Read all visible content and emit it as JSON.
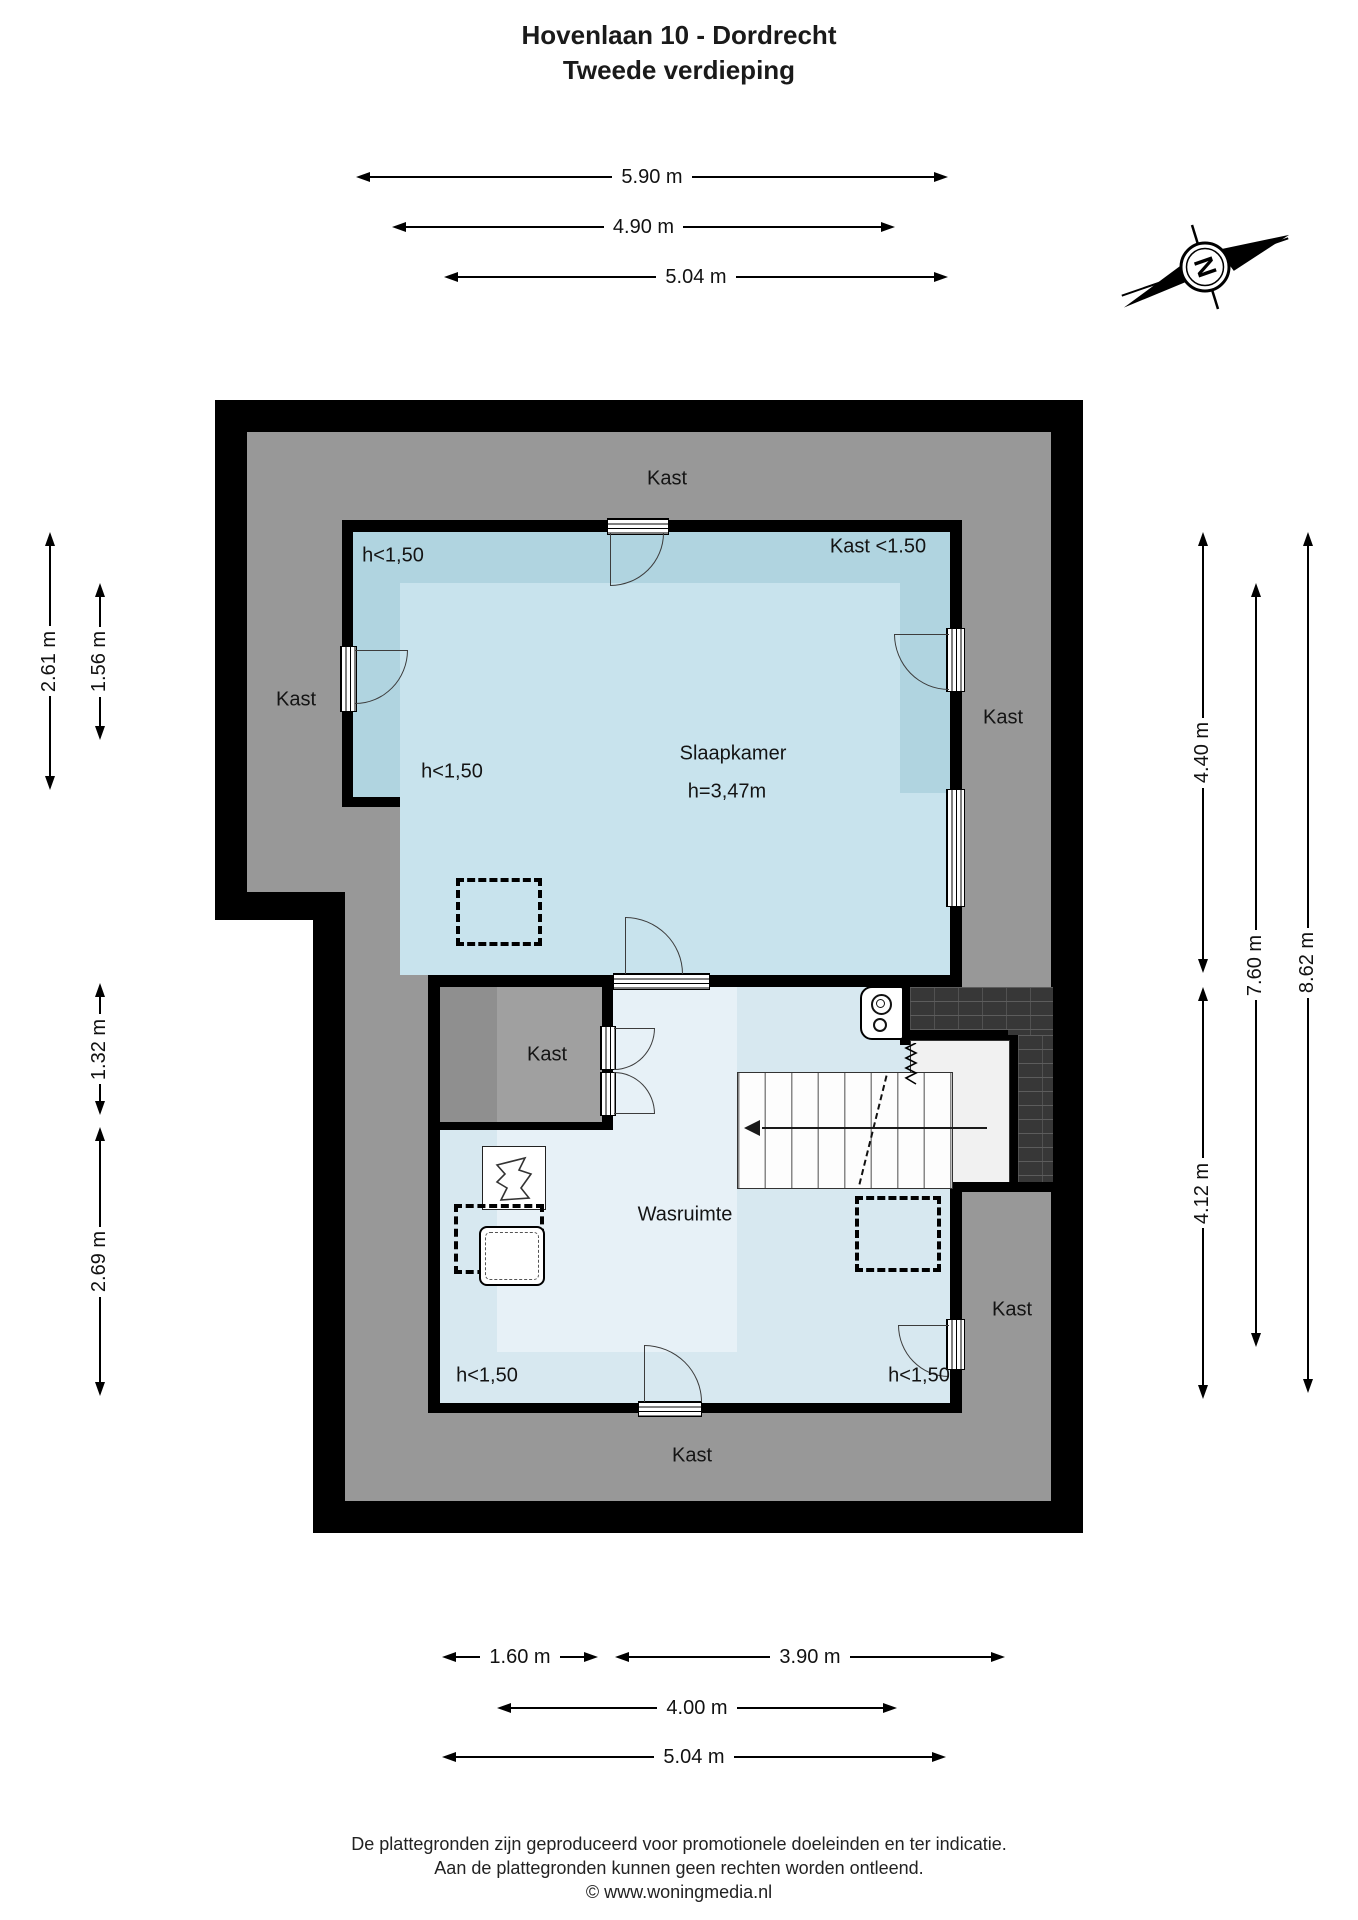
{
  "title": {
    "line1": "Hovenlaan 10 - Dordrecht",
    "line2": "Tweede verdieping"
  },
  "compass": {
    "letter": "N"
  },
  "floor_plan": {
    "rooms": {
      "slaapkamer": {
        "name": "Slaapkamer",
        "ceiling_height": "h=3,47m"
      },
      "wasruimte": {
        "name": "Wasruimte"
      }
    },
    "closet_labels": {
      "top": "Kast",
      "left": "Kast",
      "right_upper": "Kast",
      "middle": "Kast",
      "right_lower": "Kast",
      "bottom": "Kast",
      "top_right_low": "Kast <1.50"
    },
    "low_height_labels": {
      "bedroom_upper_left": "h<1,50",
      "bedroom_lower_left": "h<1,50",
      "wasruimte_lower_left": "h<1,50",
      "wasruimte_lower_right": "h<1,50"
    }
  },
  "dimensions": {
    "top": [
      {
        "label": "5.90 m"
      },
      {
        "label": "4.90 m"
      },
      {
        "label": "5.04 m"
      }
    ],
    "left": [
      {
        "label": "2.61 m"
      },
      {
        "label": "1.56 m"
      },
      {
        "label": "1.32 m"
      },
      {
        "label": "2.69 m"
      }
    ],
    "right": [
      {
        "label": "4.40 m"
      },
      {
        "label": "7.60 m"
      },
      {
        "label": "8.62 m"
      },
      {
        "label": "4.12 m"
      }
    ],
    "bottom": [
      {
        "label": "1.60 m"
      },
      {
        "label": "3.90 m"
      },
      {
        "label": "4.00 m"
      },
      {
        "label": "5.04 m"
      }
    ]
  },
  "footer": {
    "line1": "De plattegronden zijn geproduceerd voor promotionele doeleinden en ter indicatie.",
    "line2": "Aan de plattegronden kunnen geen rechten worden ontleend.",
    "line3": "© www.woningmedia.nl"
  },
  "colors": {
    "wall": "#000000",
    "closet-gray": "#989898",
    "closet-gray-light": "#a0a0a0",
    "closet-gray-dark": "#8f8f8f",
    "bedroom-fill": "#b0d4e0",
    "bedroom-fill-light": "#c8e3ed",
    "laundry-fill": "#d7e8f0",
    "laundry-fill-light": "#e7f1f7",
    "landing-fill": "#f1f1f1",
    "tile-dark": "#373737"
  }
}
